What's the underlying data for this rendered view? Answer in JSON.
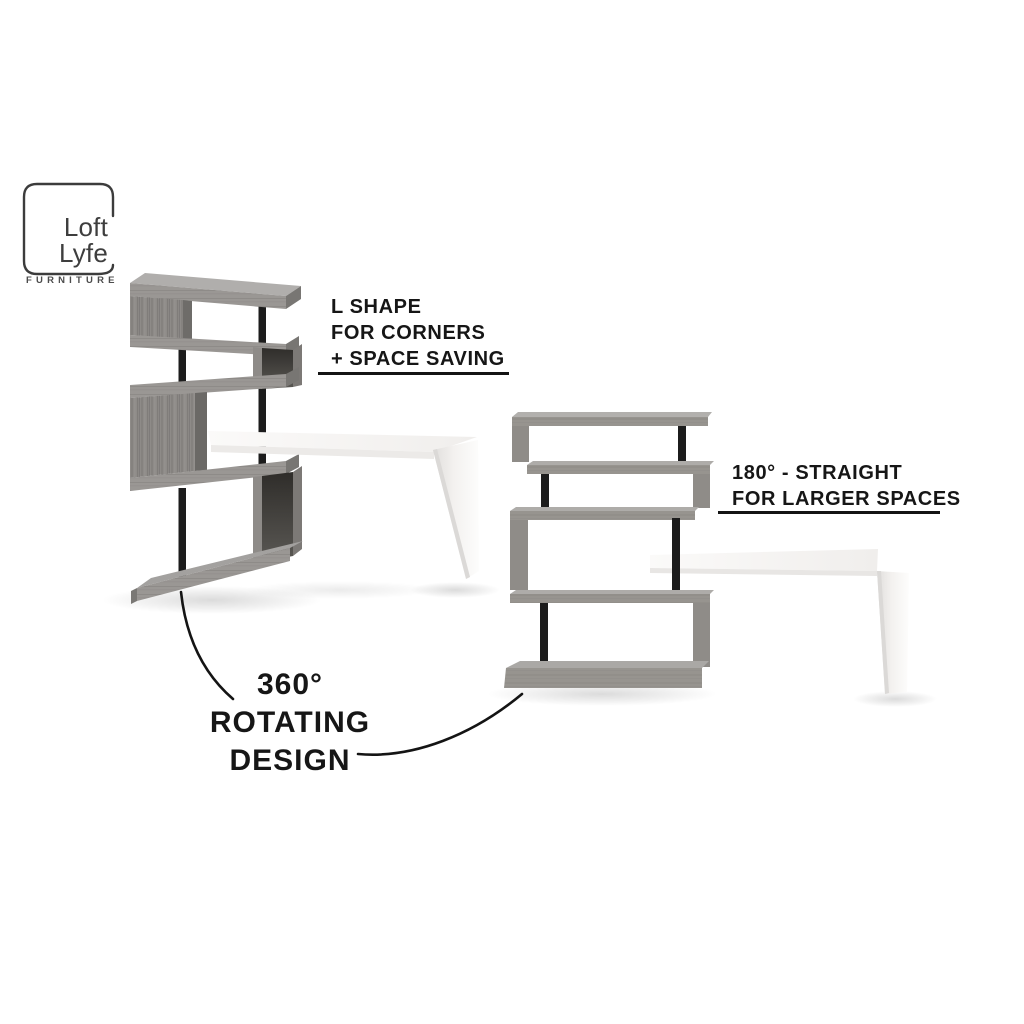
{
  "brand": {
    "name_line1": "Loft",
    "name_line2": "Lyfe",
    "tagline": "FURNITURE"
  },
  "callouts": {
    "l_shape": {
      "lines": [
        "L SHAPE",
        "FOR CORNERS",
        "+ SPACE SAVING"
      ]
    },
    "straight": {
      "lines": [
        "180° - STRAIGHT",
        "FOR LARGER SPACES"
      ]
    },
    "rotating": {
      "lines": [
        "360°",
        "ROTATING",
        "DESIGN"
      ]
    }
  },
  "colors": {
    "text": "#161616",
    "underline": "#141414",
    "logo_ink": "#3e3e3e",
    "wood": "#949290",
    "wood_dark": "#6e6c6a",
    "wood_top": "#adabaa",
    "pole_black": "#1c1c1c",
    "desk_white": "#f7f6f4",
    "background": "#ffffff"
  }
}
